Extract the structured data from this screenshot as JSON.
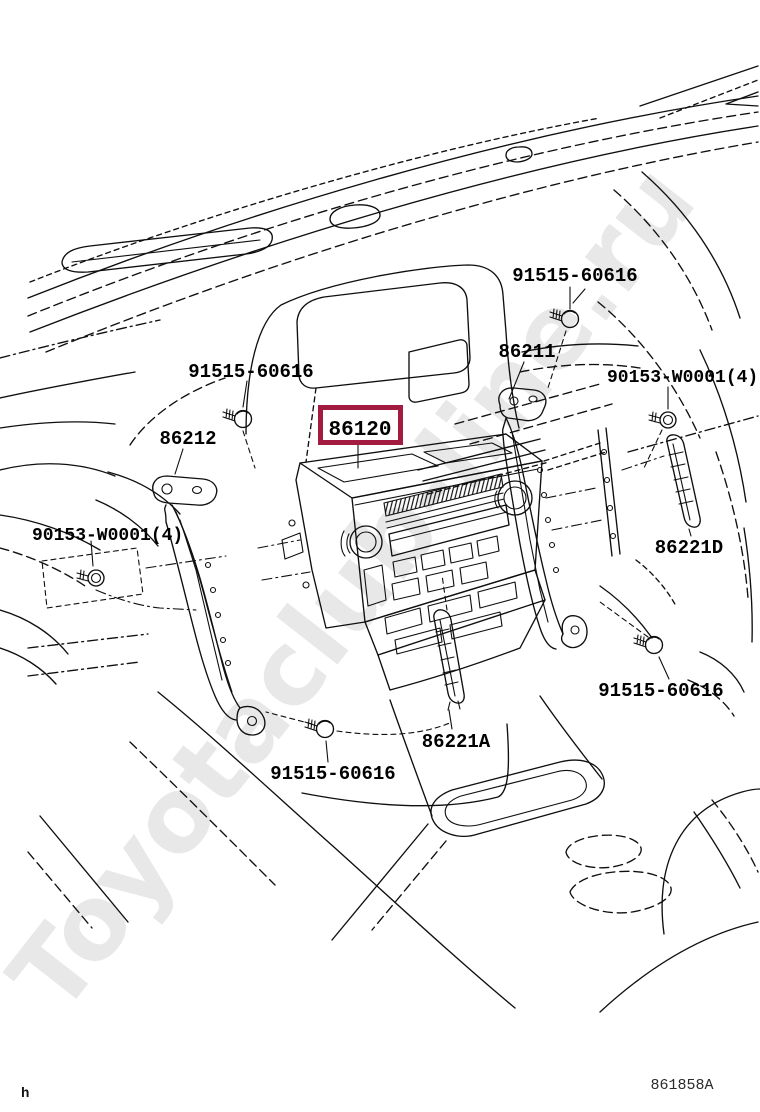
{
  "page": {
    "background": "#ffffff"
  },
  "diagram": {
    "type": "exploded-parts-diagram",
    "subject": "radio-receiver-and-mounting-brackets-in-instrument-panel",
    "watermark": "Toyotaclub-line.ru",
    "footer_code": "861858A",
    "corner_mark": "h",
    "highlight": {
      "part_number": "86120",
      "border_color": "#A21C41"
    },
    "labels": [
      {
        "id": "screw-top",
        "text": "91515-60616"
      },
      {
        "id": "bracket-right",
        "text": "86211"
      },
      {
        "id": "bolt-right",
        "text": "90153-W0001(4)"
      },
      {
        "id": "screw-upper-left",
        "text": "91515-60616"
      },
      {
        "id": "bracket-left",
        "text": "86212"
      },
      {
        "id": "receiver-assy",
        "text": "86120"
      },
      {
        "id": "bolt-left",
        "text": "90153-W0001(4)"
      },
      {
        "id": "garnish-right",
        "text": "86221D"
      },
      {
        "id": "screw-lower-right",
        "text": "91515-60616"
      },
      {
        "id": "garnish-center",
        "text": "86221A"
      },
      {
        "id": "screw-lower-left",
        "text": "91515-60616"
      }
    ]
  }
}
